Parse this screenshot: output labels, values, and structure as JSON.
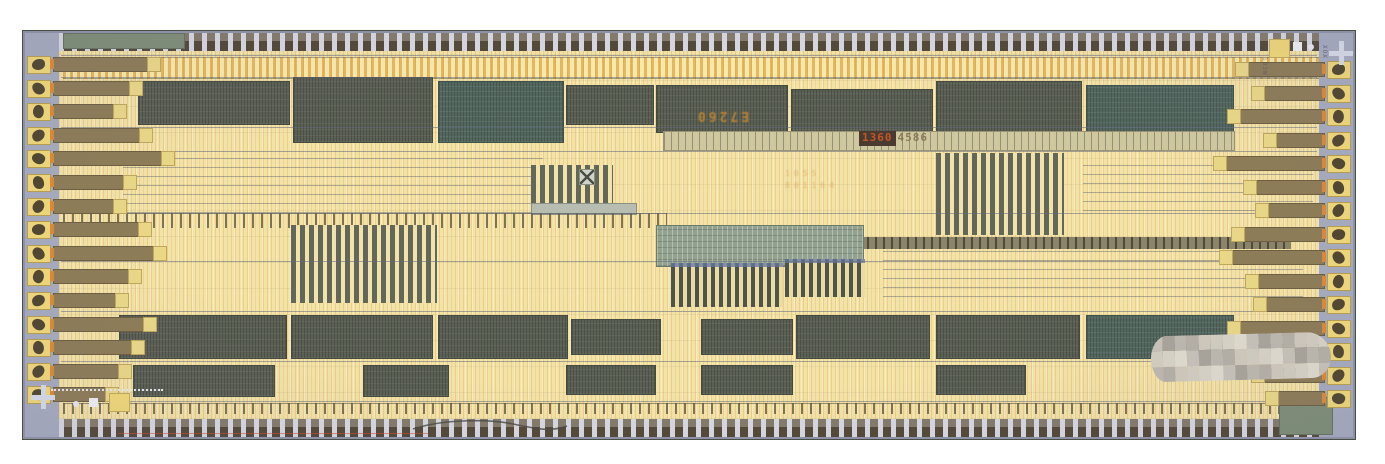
{
  "image_type": "integrated-circuit die micrograph photograph",
  "die": {
    "markings": {
      "center_mirrored": "E7260",
      "serial_boxed": "1360",
      "serial_plain": "4586",
      "faint_line1": "1055",
      "faint_line2": "801164",
      "vertical_topright": "XOX",
      "vertical_right": "103W"
    },
    "palette": {
      "page_bg": "#ffffff",
      "ring": "#a6abbf",
      "core": "#f2e3a9",
      "pad": "#f0d878",
      "probe_mark": "#3e3628",
      "trace": "#8d7c57",
      "block_dark": "#5b6054",
      "block_teal": "#53675e",
      "analog_texture": "#93a18f",
      "cross": "#d7dce8",
      "marking_orange": "#c8872f",
      "marking_red": "#c2552a"
    },
    "pads": {
      "left": {
        "count": 15,
        "first_y": 25,
        "pitch": 23.6,
        "trace_lengths": [
          104,
          86,
          70,
          96,
          118,
          80,
          70,
          95,
          110,
          85,
          72,
          100,
          88,
          75,
          62
        ]
      },
      "right": {
        "count": 15,
        "first_y": 30,
        "pitch": 23.5,
        "trace_lengths": [
          88,
          72,
          96,
          60,
          110,
          80,
          68,
          92,
          104,
          78,
          70,
          96,
          84,
          72,
          58
        ]
      }
    },
    "hlines": [
      24,
      46,
      96,
      120,
      182,
      230,
      280,
      330,
      370
    ],
    "blocks": [
      {
        "t": "routing",
        "x": 40,
        "y": 26,
        "w": 1256,
        "h": 20
      },
      {
        "t": "dark",
        "x": 115,
        "y": 50,
        "w": 150,
        "h": 42
      },
      {
        "t": "dark",
        "x": 270,
        "y": 46,
        "w": 138,
        "h": 64
      },
      {
        "t": "teal",
        "x": 415,
        "y": 50,
        "w": 124,
        "h": 60
      },
      {
        "t": "dark",
        "x": 543,
        "y": 54,
        "w": 86,
        "h": 38
      },
      {
        "t": "dark",
        "x": 633,
        "y": 54,
        "w": 130,
        "h": 46
      },
      {
        "t": "dark",
        "x": 768,
        "y": 58,
        "w": 140,
        "h": 46
      },
      {
        "t": "dark",
        "x": 913,
        "y": 50,
        "w": 144,
        "h": 56
      },
      {
        "t": "teal",
        "x": 1063,
        "y": 54,
        "w": 146,
        "h": 52
      },
      {
        "t": "comb",
        "x": 640,
        "y": 100,
        "w": 570,
        "h": 18
      },
      {
        "t": "hlines",
        "x": 100,
        "y": 126,
        "w": 420,
        "h": 56
      },
      {
        "t": "stripes",
        "x": 508,
        "y": 134,
        "w": 82,
        "h": 38
      },
      {
        "t": "graybar",
        "x": 508,
        "y": 172,
        "w": 104,
        "h": 10
      },
      {
        "t": "stripes",
        "x": 913,
        "y": 122,
        "w": 128,
        "h": 82
      },
      {
        "t": "hlines",
        "x": 1060,
        "y": 130,
        "w": 230,
        "h": 50
      },
      {
        "t": "ticks",
        "x": 40,
        "y": 182,
        "w": 604,
        "h": 14
      },
      {
        "t": "ticksdark",
        "x": 748,
        "y": 206,
        "w": 520,
        "h": 12
      },
      {
        "t": "stripes",
        "x": 268,
        "y": 194,
        "w": 146,
        "h": 78
      },
      {
        "t": "analog",
        "x": 633,
        "y": 194,
        "w": 206,
        "h": 40
      },
      {
        "t": "fingers",
        "x": 648,
        "y": 232,
        "w": 112,
        "h": 44
      },
      {
        "t": "fingers",
        "x": 762,
        "y": 228,
        "w": 80,
        "h": 38
      },
      {
        "t": "hlines",
        "x": 860,
        "y": 214,
        "w": 420,
        "h": 52
      },
      {
        "t": "dark",
        "x": 96,
        "y": 284,
        "w": 166,
        "h": 42
      },
      {
        "t": "dark",
        "x": 268,
        "y": 284,
        "w": 140,
        "h": 42
      },
      {
        "t": "dark",
        "x": 415,
        "y": 284,
        "w": 128,
        "h": 42
      },
      {
        "t": "dark",
        "x": 548,
        "y": 288,
        "w": 88,
        "h": 34
      },
      {
        "t": "dark",
        "x": 678,
        "y": 288,
        "w": 90,
        "h": 34
      },
      {
        "t": "dark",
        "x": 773,
        "y": 284,
        "w": 132,
        "h": 42
      },
      {
        "t": "dark",
        "x": 913,
        "y": 284,
        "w": 142,
        "h": 42
      },
      {
        "t": "teal",
        "x": 1063,
        "y": 284,
        "w": 146,
        "h": 42
      },
      {
        "t": "dark",
        "x": 110,
        "y": 334,
        "w": 140,
        "h": 30
      },
      {
        "t": "dark",
        "x": 340,
        "y": 334,
        "w": 84,
        "h": 30
      },
      {
        "t": "dark",
        "x": 543,
        "y": 334,
        "w": 88,
        "h": 28
      },
      {
        "t": "dark",
        "x": 678,
        "y": 334,
        "w": 90,
        "h": 28
      },
      {
        "t": "dark",
        "x": 913,
        "y": 334,
        "w": 88,
        "h": 28
      },
      {
        "t": "ticks",
        "x": 40,
        "y": 372,
        "w": 1230,
        "h": 10
      },
      {
        "t": "green",
        "x": 40,
        "y": 2,
        "w": 120,
        "h": 14
      },
      {
        "t": "green",
        "x": 1256,
        "y": 366,
        "w": 52,
        "h": 36
      }
    ],
    "redaction": {
      "x": 1128,
      "y": 303,
      "w": 180,
      "h": 46,
      "cols": 15,
      "rows": 3,
      "colors": [
        "#c7c2b8",
        "#b5b0a6",
        "#d8d3c6",
        "#a9a49a",
        "#cfc9bc",
        "#e0dbce",
        "#bdb8ae",
        "#d2cdc0"
      ]
    }
  }
}
